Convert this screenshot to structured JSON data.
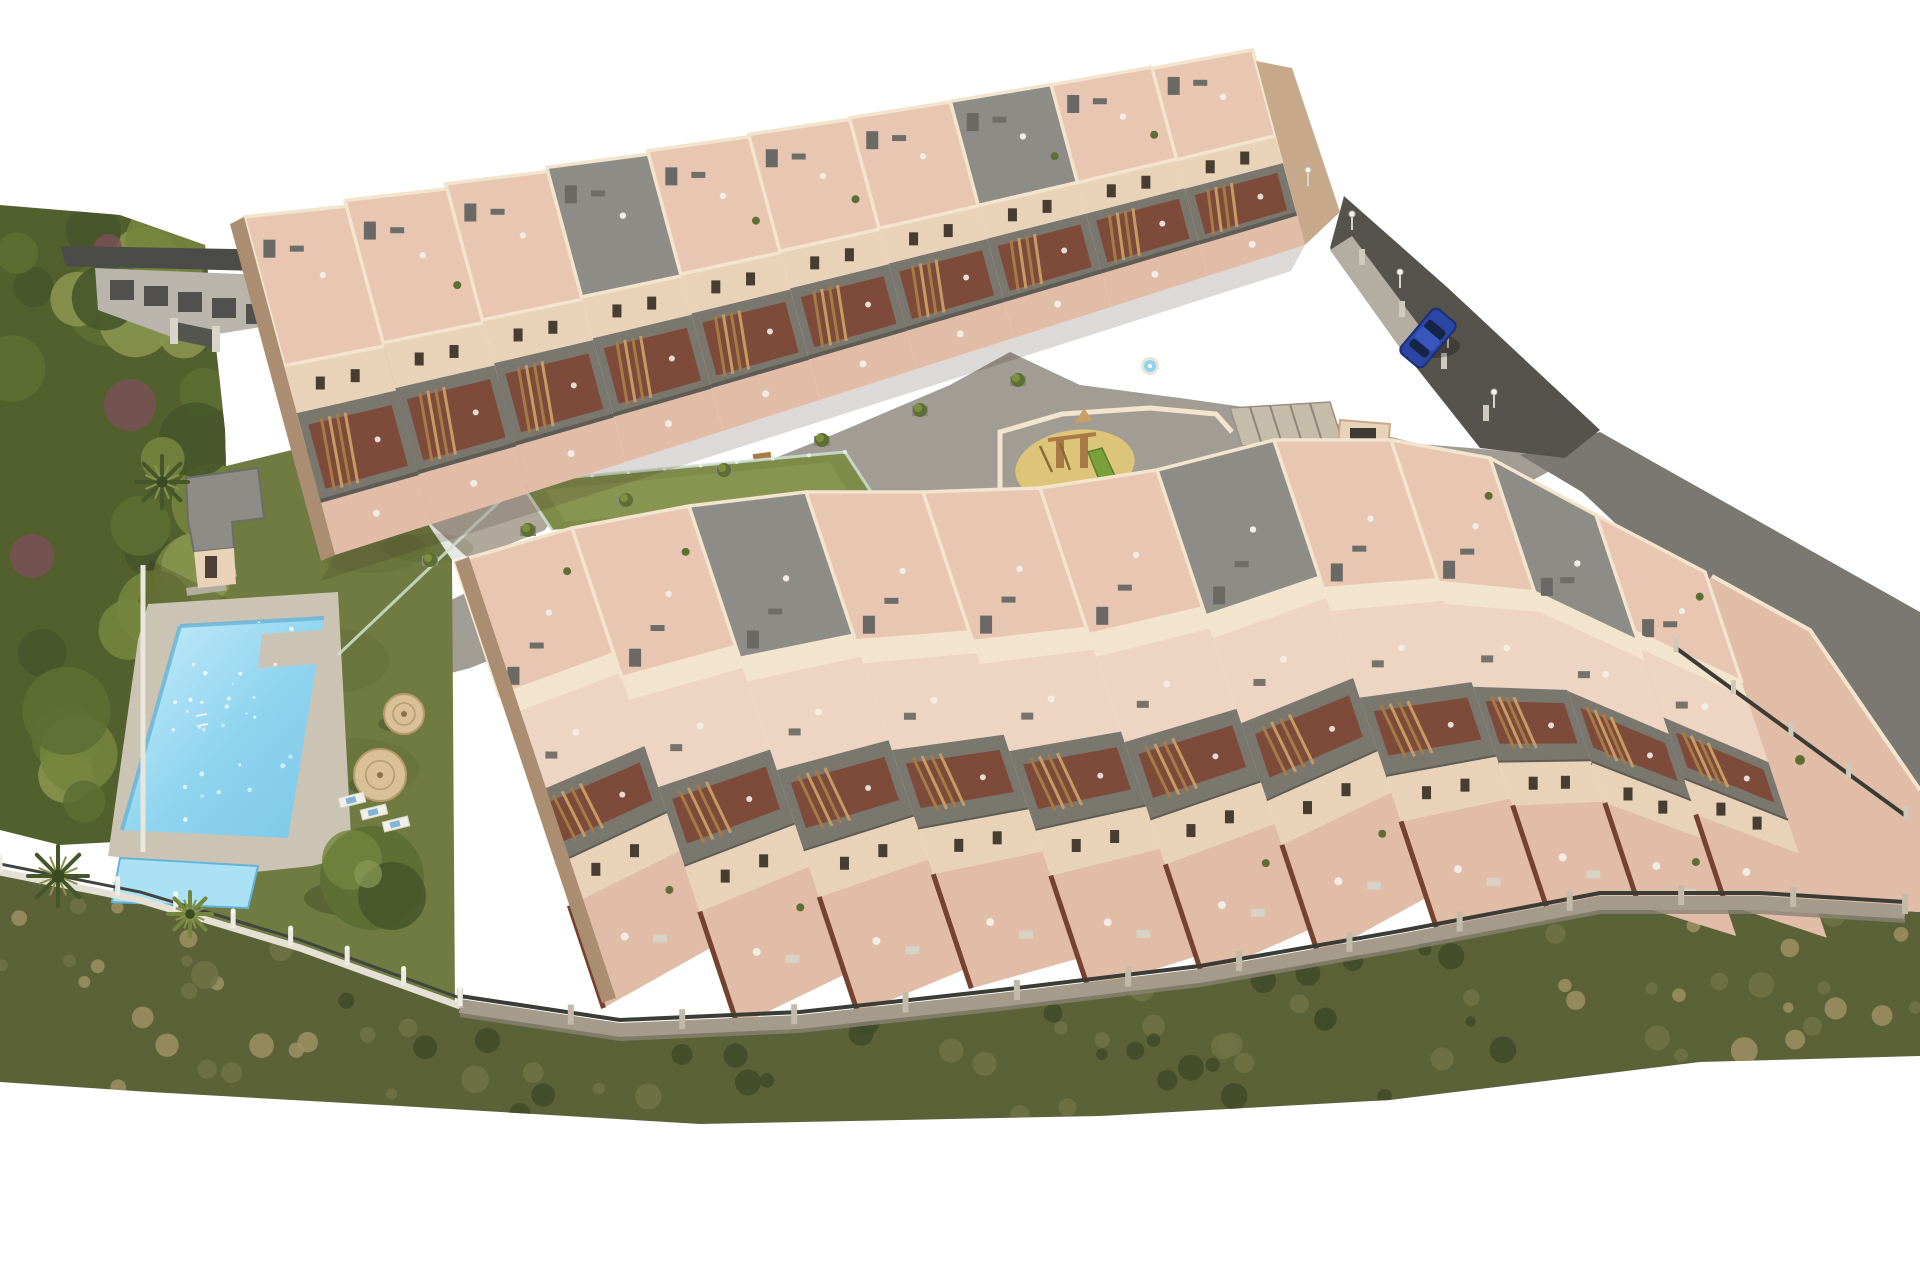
{
  "scene": {
    "description": "Aerial 3D architectural rendering of a hillside residential apartment complex with stepped rooftop terraces, balconies with wooden stairs, a communal swimming pool with kids pool, lawn garden, straw umbrellas, central playground, green sports court, perimeter walls and a road with one parked blue car",
    "background": "#ffffff",
    "visible_text": "none"
  },
  "palette": {
    "bg": "#ffffff",
    "plaza": "#a19c94",
    "driveway": "#9d9992",
    "walkLight": "#b3ada2",
    "road": "#56534d",
    "embankment": "#7b7771",
    "lawn": "#6f7b40",
    "court": "#7e8b49",
    "courtLight": "#909c55",
    "treeDark": "#46562b",
    "treeMid": "#5d6f33",
    "treeLight": "#74853e",
    "treeOlive": "#87934e",
    "shrubPurple": "#7c5059",
    "scrubBase": "#5c6238",
    "scrubDark": "#3f4b28",
    "scrubMid": "#6e7345",
    "scrubDry": "#9d9164",
    "poolWater": "#8fd4ef",
    "poolLight": "#c9edf9",
    "poolEdge": "#64b4d9",
    "kidsPool": "#abe1f4",
    "deck": "#cbc4b4",
    "sand": "#dcc478",
    "wood": "#a87a45",
    "woodLight": "#c99b63",
    "roofTile": "#e8c6b2",
    "terracePale": "#eed4c2",
    "groundTerrace": "#e1bca7",
    "wallCream": "#e8d3b9",
    "wallLight": "#f3e4cd",
    "wallDark": "#c8a88b",
    "wallShadow": "#ab8d72",
    "balconyGray": "#7a776f",
    "balconyDark": "#5e5c55",
    "recessBrown": "#7e4836",
    "grayRoof": "#8e8c87",
    "neighborRoof": "#4b4b49",
    "neighborWall": "#b9b5ad",
    "stoneWall": "#a49b8b",
    "fenceDark": "#3c3c36",
    "postWhite": "#edebe3",
    "glass": "#cfe0d5",
    "carBlue": "#2b46a4",
    "umbrella": "#d9c096",
    "white": "#f1ede4",
    "windowDark": "#473d31",
    "chimney": "#6b6965"
  },
  "seed": 7,
  "plaza": [
    [
      335,
      655
    ],
    [
      430,
      610
    ],
    [
      560,
      548
    ],
    [
      700,
      488
    ],
    [
      830,
      436
    ],
    [
      950,
      385
    ],
    [
      1010,
      352
    ],
    [
      1080,
      385
    ],
    [
      1180,
      398
    ],
    [
      1300,
      415
    ],
    [
      1420,
      444
    ],
    [
      1520,
      452
    ],
    [
      1585,
      452
    ],
    [
      1500,
      498
    ],
    [
      1390,
      540
    ],
    [
      1260,
      568
    ],
    [
      1130,
      542
    ],
    [
      1000,
      512
    ],
    [
      870,
      522
    ],
    [
      740,
      562
    ],
    [
      600,
      617
    ],
    [
      470,
      668
    ],
    [
      380,
      692
    ]
  ],
  "driveway": [
    [
      296,
      300
    ],
    [
      470,
      360
    ],
    [
      560,
      430
    ],
    [
      520,
      470
    ],
    [
      380,
      430
    ],
    [
      292,
      352
    ]
  ],
  "path2": [
    [
      380,
      430
    ],
    [
      560,
      432
    ],
    [
      585,
      470
    ],
    [
      545,
      530
    ],
    [
      470,
      560
    ],
    [
      372,
      470
    ]
  ],
  "lawn": [
    [
      210,
      470
    ],
    [
      300,
      448
    ],
    [
      392,
      470
    ],
    [
      452,
      560
    ],
    [
      455,
      1005
    ],
    [
      340,
      1085
    ],
    [
      190,
      1000
    ],
    [
      140,
      852
    ],
    [
      140,
      610
    ],
    [
      180,
      560
    ]
  ],
  "embankment": [
    [
      1600,
      432
    ],
    [
      1920,
      612
    ],
    [
      1920,
      800
    ],
    [
      1745,
      645
    ],
    [
      1582,
      492
    ],
    [
      1520,
      455
    ]
  ],
  "road": {
    "poly": [
      [
        1344,
        196
      ],
      [
        1448,
        288
      ],
      [
        1600,
        430
      ],
      [
        1565,
        458
      ],
      [
        1480,
        448
      ],
      [
        1404,
        352
      ],
      [
        1330,
        248
      ]
    ],
    "walk": [
      [
        1330,
        250
      ],
      [
        1352,
        236
      ],
      [
        1424,
        332
      ],
      [
        1400,
        348
      ]
    ],
    "lamps": [
      [
        1352,
        230
      ],
      [
        1400,
        288
      ],
      [
        1448,
        348
      ],
      [
        1494,
        408
      ],
      [
        1308,
        186
      ]
    ],
    "wall_posts": [
      [
        1362,
        258
      ],
      [
        1402,
        310
      ],
      [
        1444,
        362
      ],
      [
        1486,
        414
      ]
    ]
  },
  "car": {
    "x": 1428,
    "y": 338,
    "angle": 40,
    "w": 30,
    "l": 58
  },
  "forest": {
    "outline": [
      [
        0,
        205
      ],
      [
        120,
        215
      ],
      [
        205,
        245
      ],
      [
        225,
        430
      ],
      [
        230,
        610
      ],
      [
        205,
        700
      ],
      [
        255,
        725
      ],
      [
        270,
        790
      ],
      [
        150,
        840
      ],
      [
        60,
        845
      ],
      [
        0,
        830
      ]
    ],
    "count": 34,
    "x_range": [
      12,
      218
    ],
    "y_range": [
      225,
      805
    ],
    "r_range": [
      20,
      46
    ],
    "purple_blobs": [
      [
        130,
        405,
        26
      ],
      [
        32,
        556,
        22
      ],
      [
        264,
        728,
        32
      ],
      [
        196,
        768,
        18
      ],
      [
        108,
        248,
        14
      ]
    ]
  },
  "palms": [
    [
      58,
      876,
      30
    ],
    [
      162,
      482,
      26
    ]
  ],
  "fan_palm": [
    190,
    914,
    22
  ],
  "big_tree": [
    372,
    878,
    52
  ],
  "neighbor": {
    "roof": [
      [
        60,
        246
      ],
      [
        290,
        250
      ],
      [
        296,
        272
      ],
      [
        66,
        266
      ]
    ],
    "roof2": [
      [
        290,
        252
      ],
      [
        452,
        306
      ],
      [
        440,
        322
      ],
      [
        286,
        272
      ]
    ],
    "wall": [
      [
        95,
        268
      ],
      [
        290,
        276
      ],
      [
        292,
        322
      ],
      [
        180,
        340
      ],
      [
        98,
        310
      ]
    ],
    "gate": [
      [
        176,
        322
      ],
      [
        214,
        330
      ],
      [
        214,
        348
      ],
      [
        176,
        340
      ]
    ]
  },
  "pool": {
    "deck": [
      [
        148,
        604
      ],
      [
        338,
        592
      ],
      [
        352,
        856
      ],
      [
        312,
        866
      ],
      [
        255,
        872
      ],
      [
        108,
        856
      ],
      [
        138,
        640
      ]
    ],
    "main": [
      [
        180,
        626
      ],
      [
        324,
        618
      ],
      [
        288,
        838
      ],
      [
        122,
        830
      ]
    ],
    "step": [
      [
        262,
        634
      ],
      [
        322,
        630
      ],
      [
        318,
        664
      ],
      [
        258,
        668
      ]
    ],
    "kids": [
      [
        120,
        858
      ],
      [
        258,
        866
      ],
      [
        248,
        908
      ],
      [
        112,
        902
      ]
    ],
    "ladder": [
      198,
      722
    ],
    "steps": [
      [
        186,
        588
      ],
      [
        196,
        574
      ]
    ],
    "sparkle_count": 40
  },
  "pool_house": {
    "roof": [
      [
        186,
        478
      ],
      [
        258,
        468
      ],
      [
        264,
        518
      ],
      [
        232,
        522
      ],
      [
        234,
        548
      ],
      [
        194,
        552
      ],
      [
        188,
        520
      ]
    ],
    "front": [
      [
        194,
        552
      ],
      [
        234,
        548
      ],
      [
        236,
        584
      ],
      [
        198,
        588
      ]
    ],
    "shadow": [
      [
        150,
        560
      ],
      [
        230,
        600
      ],
      [
        210,
        645
      ],
      [
        138,
        602
      ]
    ]
  },
  "umbrellas": [
    [
      380,
      775,
      26
    ],
    [
      404,
      714,
      20
    ]
  ],
  "loungers": [
    [
      352,
      800
    ],
    [
      374,
      812
    ],
    [
      396,
      824
    ]
  ],
  "left_wall": [
    [
      143,
      565
    ],
    [
      143,
      852
    ]
  ],
  "court": {
    "poly": [
      [
        520,
        482
      ],
      [
        845,
        452
      ],
      [
        875,
        498
      ],
      [
        552,
        530
      ]
    ],
    "stripe": [
      [
        545,
        490
      ],
      [
        830,
        462
      ],
      [
        850,
        495
      ],
      [
        565,
        522
      ]
    ],
    "bench": [
      762,
      456
    ],
    "glass_west": [
      [
        338,
        655
      ],
      [
        520,
        482
      ]
    ]
  },
  "playground": {
    "sand": [
      1075,
      466,
      60,
      36
    ],
    "wall": [
      [
        1000,
        500
      ],
      [
        1000,
        432
      ],
      [
        1062,
        414
      ],
      [
        1150,
        408
      ],
      [
        1216,
        414
      ],
      [
        1232,
        432
      ]
    ],
    "ramp": [
      [
        1230,
        408
      ],
      [
        1330,
        402
      ],
      [
        1342,
        440
      ],
      [
        1242,
        446
      ]
    ],
    "sign_wall": [
      [
        1340,
        420
      ],
      [
        1390,
        424
      ],
      [
        1388,
        452
      ],
      [
        1338,
        448
      ]
    ]
  },
  "hot_tub": [
    1150,
    366
  ],
  "planters": [
    [
      430,
      560
    ],
    [
      528,
      530
    ],
    [
      626,
      500
    ],
    [
      724,
      470
    ],
    [
      822,
      440
    ],
    [
      920,
      410
    ],
    [
      1018,
      380
    ]
  ],
  "scrub": {
    "poly": [
      [
        0,
        872
      ],
      [
        140,
        900
      ],
      [
        300,
        948
      ],
      [
        460,
        1006
      ],
      [
        620,
        1030
      ],
      [
        800,
        1022
      ],
      [
        1000,
        1002
      ],
      [
        1200,
        976
      ],
      [
        1400,
        941
      ],
      [
        1600,
        903
      ],
      [
        1760,
        903
      ],
      [
        1920,
        912
      ],
      [
        1920,
        1056
      ],
      [
        1700,
        1062
      ],
      [
        1390,
        1100
      ],
      [
        1100,
        1116
      ],
      [
        700,
        1124
      ],
      [
        400,
        1106
      ],
      [
        150,
        1092
      ],
      [
        0,
        1082
      ]
    ],
    "top": [
      [
        0,
        880
      ],
      [
        300,
        950
      ],
      [
        460,
        1008
      ],
      [
        700,
        1030
      ],
      [
        1000,
        1002
      ],
      [
        1300,
        957
      ],
      [
        1600,
        905
      ],
      [
        1920,
        915
      ]
    ],
    "bottom": [
      [
        0,
        1082
      ],
      [
        400,
        1108
      ],
      [
        700,
        1124
      ],
      [
        1100,
        1115
      ],
      [
        1390,
        1100
      ],
      [
        1700,
        1062
      ],
      [
        1920,
        1056
      ]
    ],
    "dot_count": 95
  },
  "walls": {
    "stone": [
      [
        460,
        1006
      ],
      [
        620,
        1030
      ],
      [
        800,
        1022
      ],
      [
        1000,
        1000
      ],
      [
        1200,
        976
      ],
      [
        1400,
        941
      ],
      [
        1600,
        903
      ],
      [
        1760,
        903
      ],
      [
        1905,
        912
      ]
    ],
    "stone_post_count": 14,
    "white_fence": [
      [
        0,
        872
      ],
      [
        140,
        900
      ],
      [
        300,
        948
      ],
      [
        460,
        1006
      ]
    ],
    "white_post_count": 9,
    "right_fence": [
      [
        1676,
        648
      ],
      [
        1906,
        816
      ]
    ],
    "right_post_count": 5
  },
  "upper_building": {
    "front_anchors": [
      [
        335,
        555
      ],
      [
        432,
        524
      ],
      [
        529,
        493
      ],
      [
        626,
        462
      ],
      [
        723,
        431
      ],
      [
        820,
        400
      ],
      [
        917,
        369
      ],
      [
        1014,
        338
      ],
      [
        1111,
        307
      ],
      [
        1208,
        276
      ],
      [
        1305,
        245
      ]
    ],
    "depths": [
      350,
      335,
      320,
      305,
      290,
      275,
      260,
      245,
      230,
      215
    ],
    "v": [
      -0.26,
      -0.966
    ],
    "gray_roof_bays": [
      3,
      7
    ],
    "layers": [
      {
        "f": [
          0,
          0.16
        ],
        "role": "patio",
        "color": "groundTerrace"
      },
      {
        "f": [
          0.16,
          0.42
        ],
        "role": "balcony",
        "color": "balconyGray"
      },
      {
        "f": [
          0.42,
          0.56
        ],
        "role": "wall",
        "color": "wallCream"
      },
      {
        "f": [
          0.56,
          1
        ],
        "role": "roof",
        "color": "roofTile"
      }
    ],
    "west_wall": [
      [
        335,
        555
      ],
      [
        321,
        561
      ],
      [
        230,
        224
      ],
      [
        244,
        217
      ]
    ],
    "end_wall": [
      [
        1305,
        245
      ],
      [
        1340,
        212
      ],
      [
        1292,
        68
      ],
      [
        1256,
        61
      ]
    ]
  },
  "lower_building": {
    "back_anchors": [
      [
        455,
        562
      ],
      [
        572,
        528
      ],
      [
        689,
        506
      ],
      [
        806,
        492
      ],
      [
        923,
        492
      ],
      [
        1040,
        488
      ],
      [
        1157,
        470
      ],
      [
        1274,
        440
      ],
      [
        1391,
        440
      ],
      [
        1490,
        458
      ],
      [
        1596,
        515
      ],
      [
        1705,
        572
      ]
    ],
    "depths": [
      470,
      525,
      535,
      523,
      525,
      515,
      513,
      522,
      500,
      472,
      410
    ],
    "v": [
      0.316,
      0.949
    ],
    "gray_roof_bays": [
      2,
      6,
      9
    ],
    "layers": [
      {
        "f": [
          0,
          0.3
        ],
        "role": "roof",
        "color": "roofTile"
      },
      {
        "f": [
          0.3,
          0.345
        ],
        "role": "band",
        "color": "wallLight"
      },
      {
        "f": [
          0.345,
          0.52
        ],
        "role": "terrace",
        "color": "terracePale"
      },
      {
        "f": [
          0.52,
          0.68
        ],
        "role": "balcony",
        "color": "balconyGray"
      },
      {
        "f": [
          0.68,
          0.77
        ],
        "role": "wall",
        "color": "wallCream"
      },
      {
        "f": [
          0.77,
          1
        ],
        "role": "ground",
        "color": "groundTerrace"
      }
    ],
    "west_wall": [
      [
        455,
        562
      ],
      [
        469,
        557
      ],
      [
        616,
        998
      ],
      [
        602,
        1003
      ]
    ],
    "right_terrace": [
      [
        1712,
        576
      ],
      [
        1810,
        630
      ],
      [
        1920,
        790
      ],
      [
        1920,
        912
      ],
      [
        1760,
        903
      ],
      [
        1602,
        903
      ],
      [
        1606,
        700
      ]
    ],
    "terrace_items": {
      "sofas": [
        [
          1700,
          790
        ],
        [
          1752,
          818
        ],
        [
          1672,
          852
        ],
        [
          1736,
          868
        ]
      ],
      "firepit": [
        1745,
        752
      ],
      "plants": [
        [
          1640,
          700
        ],
        [
          1800,
          760
        ]
      ],
      "rug": [
        1725,
        806
      ]
    }
  }
}
